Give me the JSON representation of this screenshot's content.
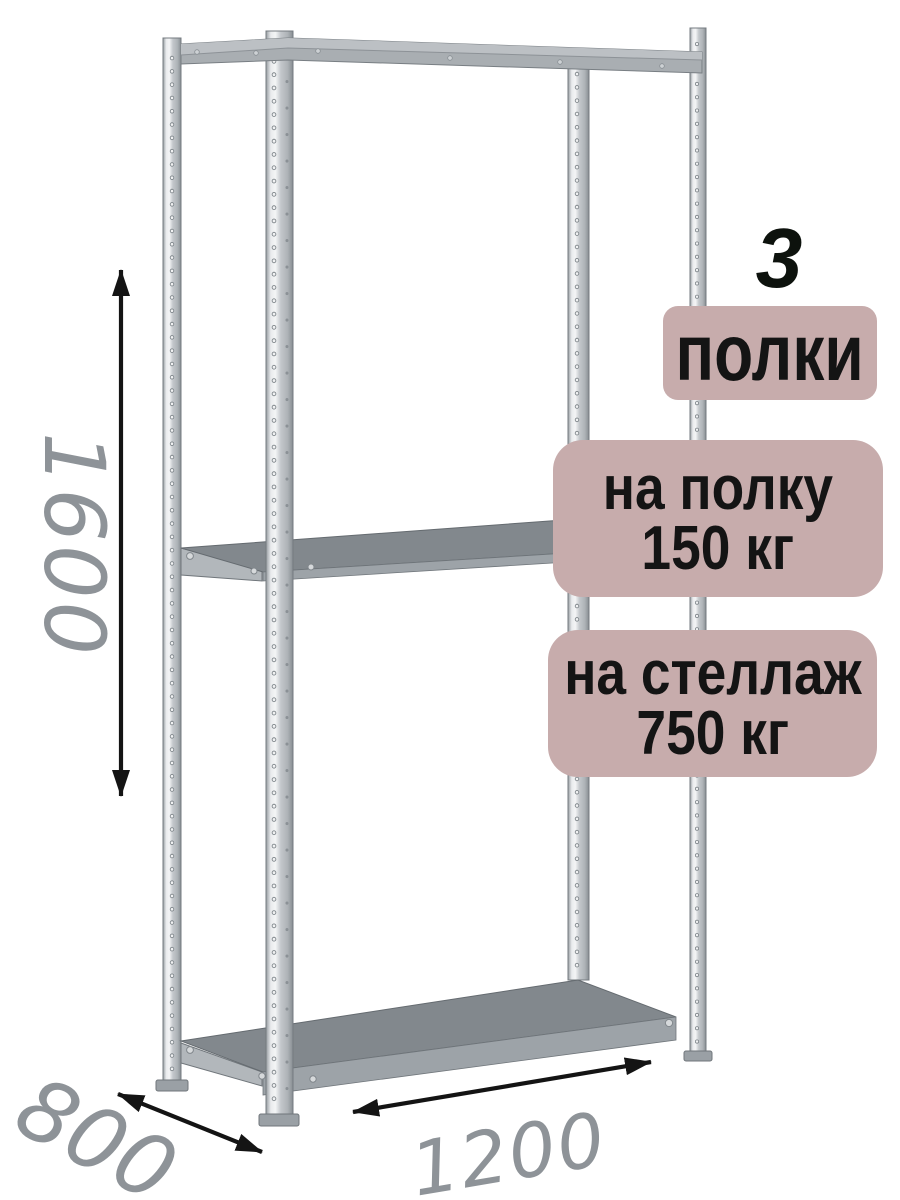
{
  "badges": {
    "shelf_count": {
      "number": "3",
      "label": "полки"
    },
    "per_shelf_load": {
      "line1": "на полку",
      "line2": "150 кг"
    },
    "total_load": {
      "line1": "на стеллаж",
      "line2": "750 кг"
    }
  },
  "annotations": {
    "height_mm": "1600",
    "depth_mm": "800",
    "width_mm": "1200"
  },
  "colors": {
    "badge_background": "#c7acac",
    "badge_text": "#141414",
    "dimension_text": "#8e9398",
    "arrow": "#141414",
    "metal_light": "#e9ebed",
    "metal_mid": "#b0b5b9",
    "metal_dark": "#888e93",
    "shelf_top_face": "#82888d",
    "background": "#ffffff"
  }
}
